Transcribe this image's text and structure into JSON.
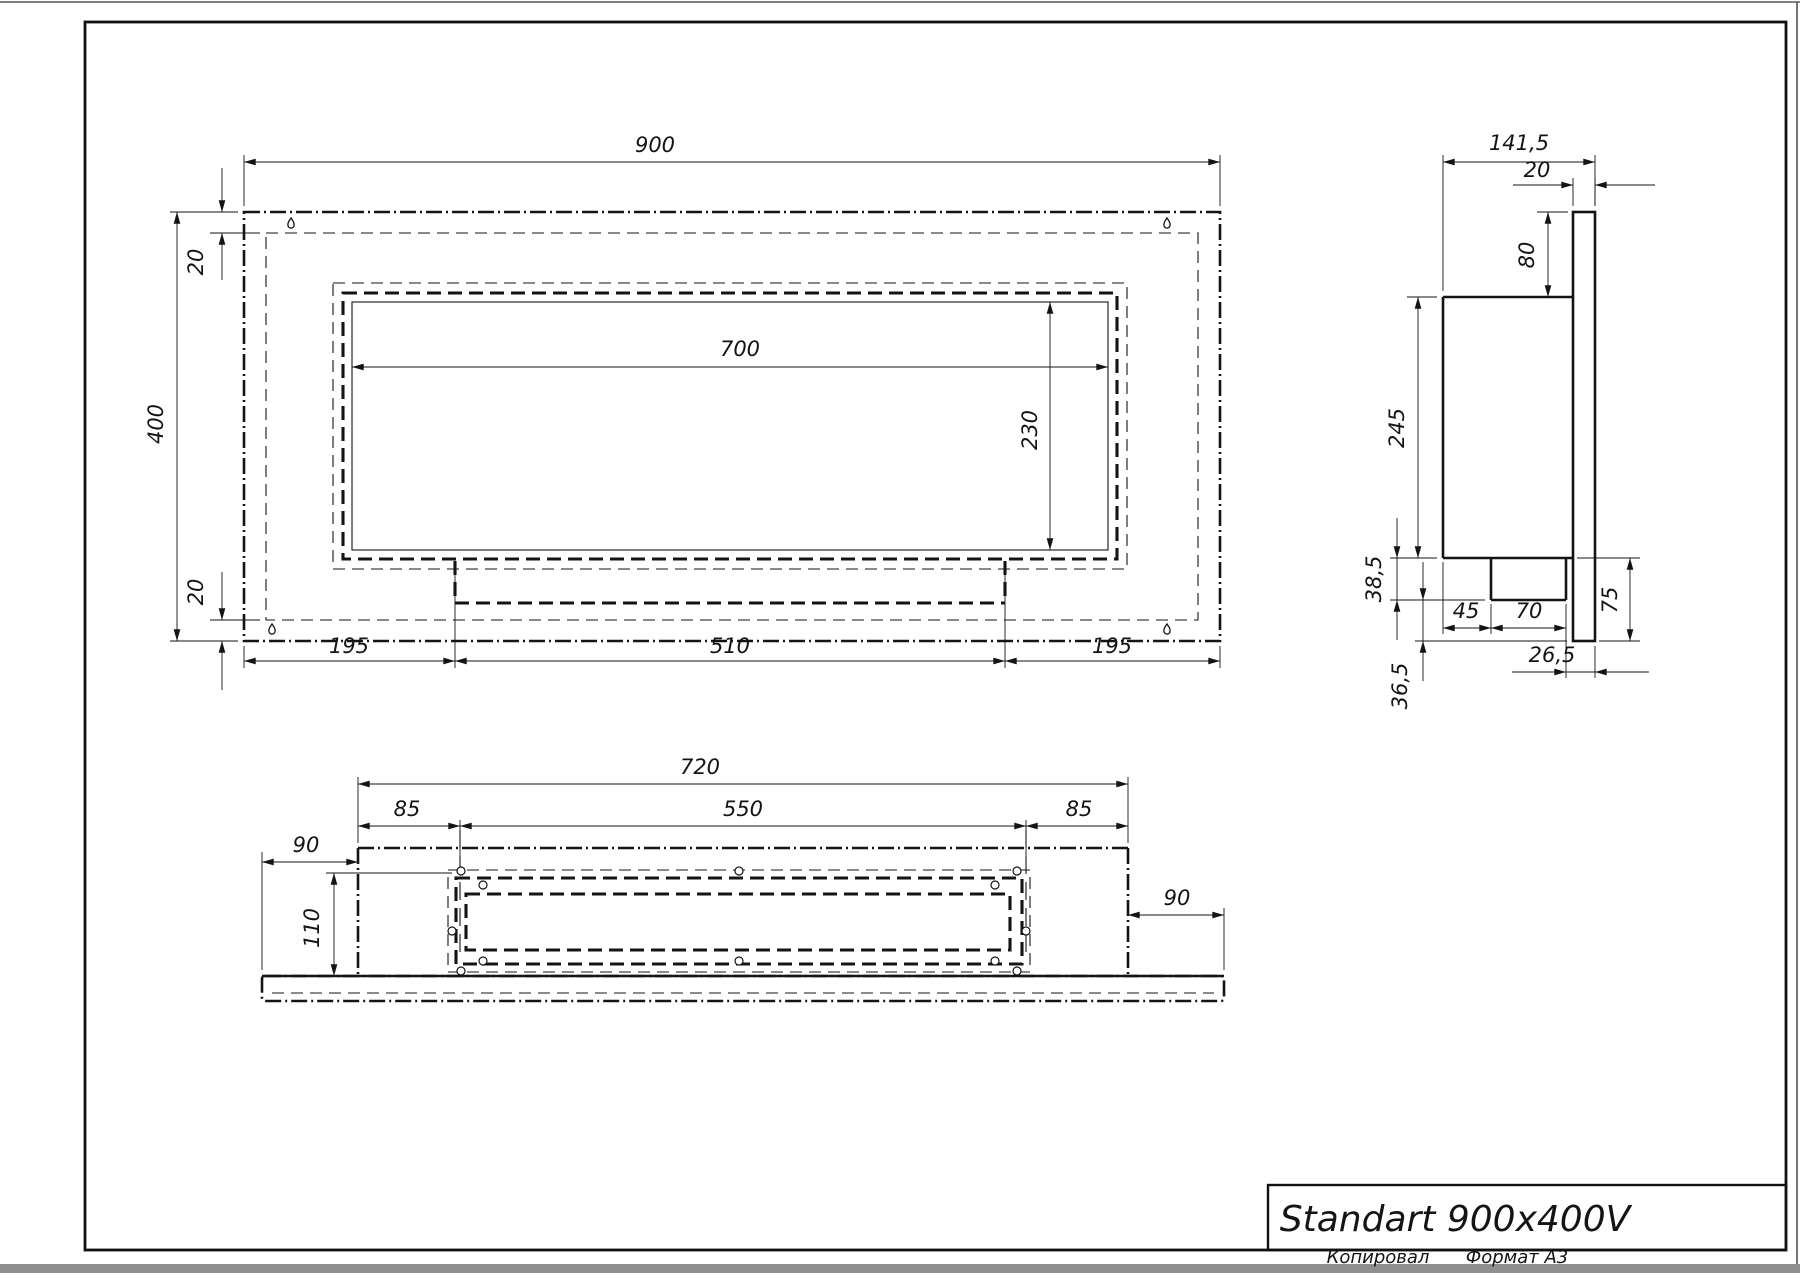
{
  "title_block": {
    "title": "Standart 900x400V"
  },
  "sheet_footer": {
    "left": "Копировал",
    "right": "Формат А3"
  },
  "front_view": {
    "dims": {
      "overall_width": "900",
      "overall_height": "400",
      "top_inset": "20",
      "bottom_inset": "20",
      "opening_width": "700",
      "opening_height": "230",
      "bottom_left": "195",
      "bottom_center": "510",
      "bottom_right": "195"
    }
  },
  "side_view": {
    "dims": {
      "overall_depth": "141,5",
      "back_panel_thickness": "20",
      "top_offset": "80",
      "body_height": "245",
      "burner_drop": "38,5",
      "front_offset": "45",
      "burner_depth": "70",
      "back_gap": "26,5",
      "lower_gap": "36,5",
      "bottom_height": "75"
    }
  },
  "bottom_view": {
    "dims": {
      "overall_width": "720",
      "left_inset": "85",
      "opening_width": "550",
      "right_inset": "85",
      "plate_left_overhang": "90",
      "plate_right_overhang": "90",
      "inner_depth": "110"
    }
  },
  "icons": {
    "keyhole": "keyhole-hanger-slot",
    "screw_hole": "round-screw-hole"
  }
}
